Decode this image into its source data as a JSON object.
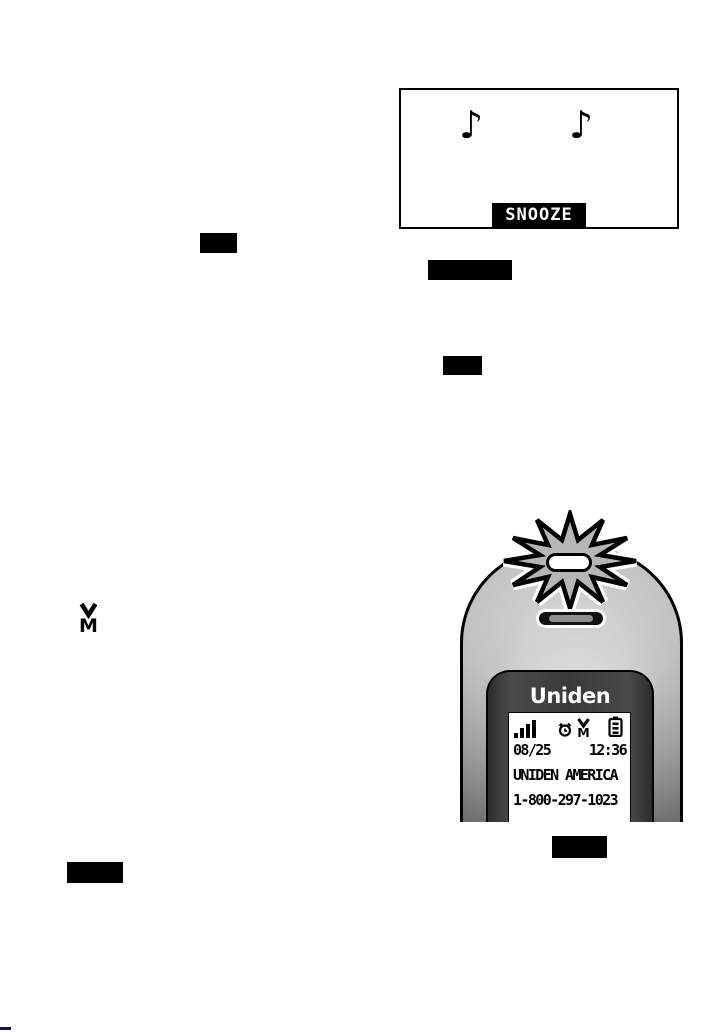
{
  "alarm_screen": {
    "note_glyph": "♪",
    "softkey_label": "SNOOZE"
  },
  "message_waiting_icon": {
    "letter": "M"
  },
  "handset": {
    "brand": "Uniden",
    "indicator": "flashing-led",
    "display": {
      "date": "08/25",
      "time": "12:36",
      "line2": "UNIDEN AMERICA",
      "line3": "1-800-297-1023",
      "status_icons": [
        "signal-strength",
        "alarm-clock",
        "message-waiting",
        "battery-level"
      ]
    }
  },
  "colors": {
    "ink": "#000000",
    "lcd_background": "#ffffff",
    "face_panel_gray": "#3a3a3a",
    "body_light_gray": "#d8d8d8",
    "body_dark_gray": "#4c4c4c"
  }
}
